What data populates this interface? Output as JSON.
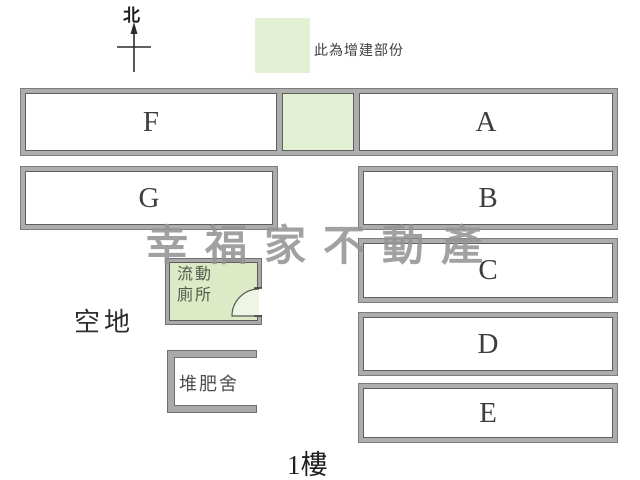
{
  "compass": {
    "label": "北"
  },
  "legend": {
    "label": "此為增建部份"
  },
  "watermark": {
    "text": "幸福家不動產"
  },
  "open_area": {
    "label": "空地"
  },
  "toilet": {
    "line1": "流動",
    "line2": "廁所"
  },
  "compost_shed": {
    "label": "堆肥舍"
  },
  "floor": {
    "label": "1樓"
  },
  "units": {
    "f": "F",
    "a": "A",
    "g": "G",
    "b": "B",
    "c": "C",
    "d": "D",
    "e": "E"
  },
  "colors": {
    "extension_green": "#e3f0d4",
    "toilet_green": "#dcebc5",
    "band_gray": "#adadad",
    "watermark_gray": "#949494"
  }
}
